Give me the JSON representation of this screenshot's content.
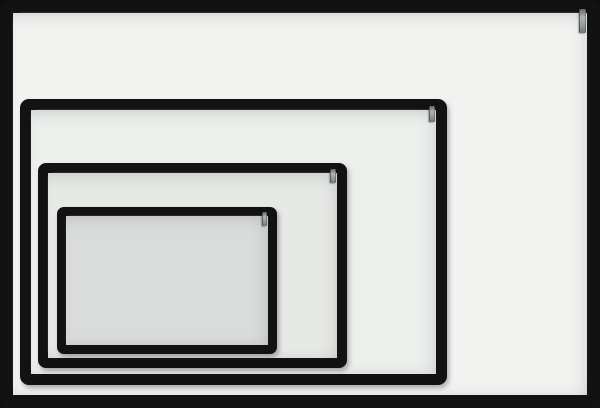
{
  "meta": {
    "scene": "Four nested black-framed magnetic whiteboards of decreasing size, photographed face-on, each fitted with a small grey metal hanging hook at the top-right inner corner",
    "frame_color": "#121212",
    "hook_color": "#9ba1a3",
    "background_color": "#f2f3f1"
  },
  "boards": [
    {
      "name": "whiteboard-xl",
      "left": 0,
      "top": 0,
      "width": 600,
      "height": 408,
      "frame_thickness": 13,
      "corner_radius": 10,
      "surface_color": "#f2f3f1",
      "hook": {
        "width": 5,
        "height": 24,
        "top_offset": -4,
        "right_offset": 1
      }
    },
    {
      "name": "whiteboard-l",
      "left": 20,
      "top": 99,
      "width": 427,
      "height": 286,
      "frame_thickness": 11,
      "corner_radius": 9,
      "surface_color": "#edefec",
      "hook": {
        "width": 4,
        "height": 16,
        "top_offset": -4,
        "right_offset": 1
      }
    },
    {
      "name": "whiteboard-m",
      "left": 38,
      "top": 163,
      "width": 309,
      "height": 205,
      "frame_thickness": 10,
      "corner_radius": 8,
      "surface_color": "#e7e9e6",
      "hook": {
        "width": 4,
        "height": 14,
        "top_offset": -4,
        "right_offset": 1
      }
    },
    {
      "name": "whiteboard-s",
      "left": 57,
      "top": 207,
      "width": 220,
      "height": 147,
      "frame_thickness": 9,
      "corner_radius": 7,
      "surface_color": "#d9dcda",
      "hook": {
        "width": 3,
        "height": 14,
        "top_offset": -4,
        "right_offset": 1
      }
    }
  ]
}
